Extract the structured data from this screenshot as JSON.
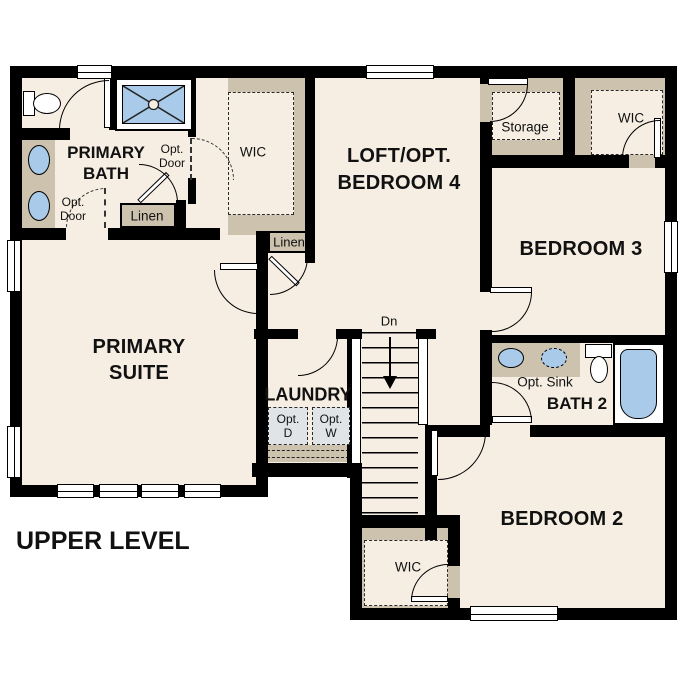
{
  "title": "UPPER LEVEL",
  "colors": {
    "wall": "#000000",
    "floor": "#f6eee3",
    "closet_fill": "#cdc2ae",
    "fixture_blue": "#a9cbe9",
    "appliance_gray": "#e0e4e6",
    "background": "#ffffff",
    "text": "#111111"
  },
  "rooms": {
    "primary_bath": "PRIMARY BATH",
    "primary_suite": "PRIMARY SUITE",
    "loft": "LOFT/OPT. BEDROOM 4",
    "bedroom3": "BEDROOM 3",
    "bedroom2": "BEDROOM 2",
    "bath2": "BATH 2",
    "laundry": "LAUNDRY"
  },
  "closets": {
    "wic_primary": "WIC",
    "wic_bedroom3": "WIC",
    "wic_bedroom2": "WIC",
    "storage": "Storage",
    "linen_bath": "Linen",
    "linen_hall": "Linen"
  },
  "annotations": {
    "opt_door_wic": "Opt. Door",
    "opt_door_suite": "Opt. Door",
    "opt_sink": "Opt. Sink",
    "opt_dryer": "Opt. D",
    "opt_washer": "Opt. W",
    "stair_direction": "Dn"
  }
}
